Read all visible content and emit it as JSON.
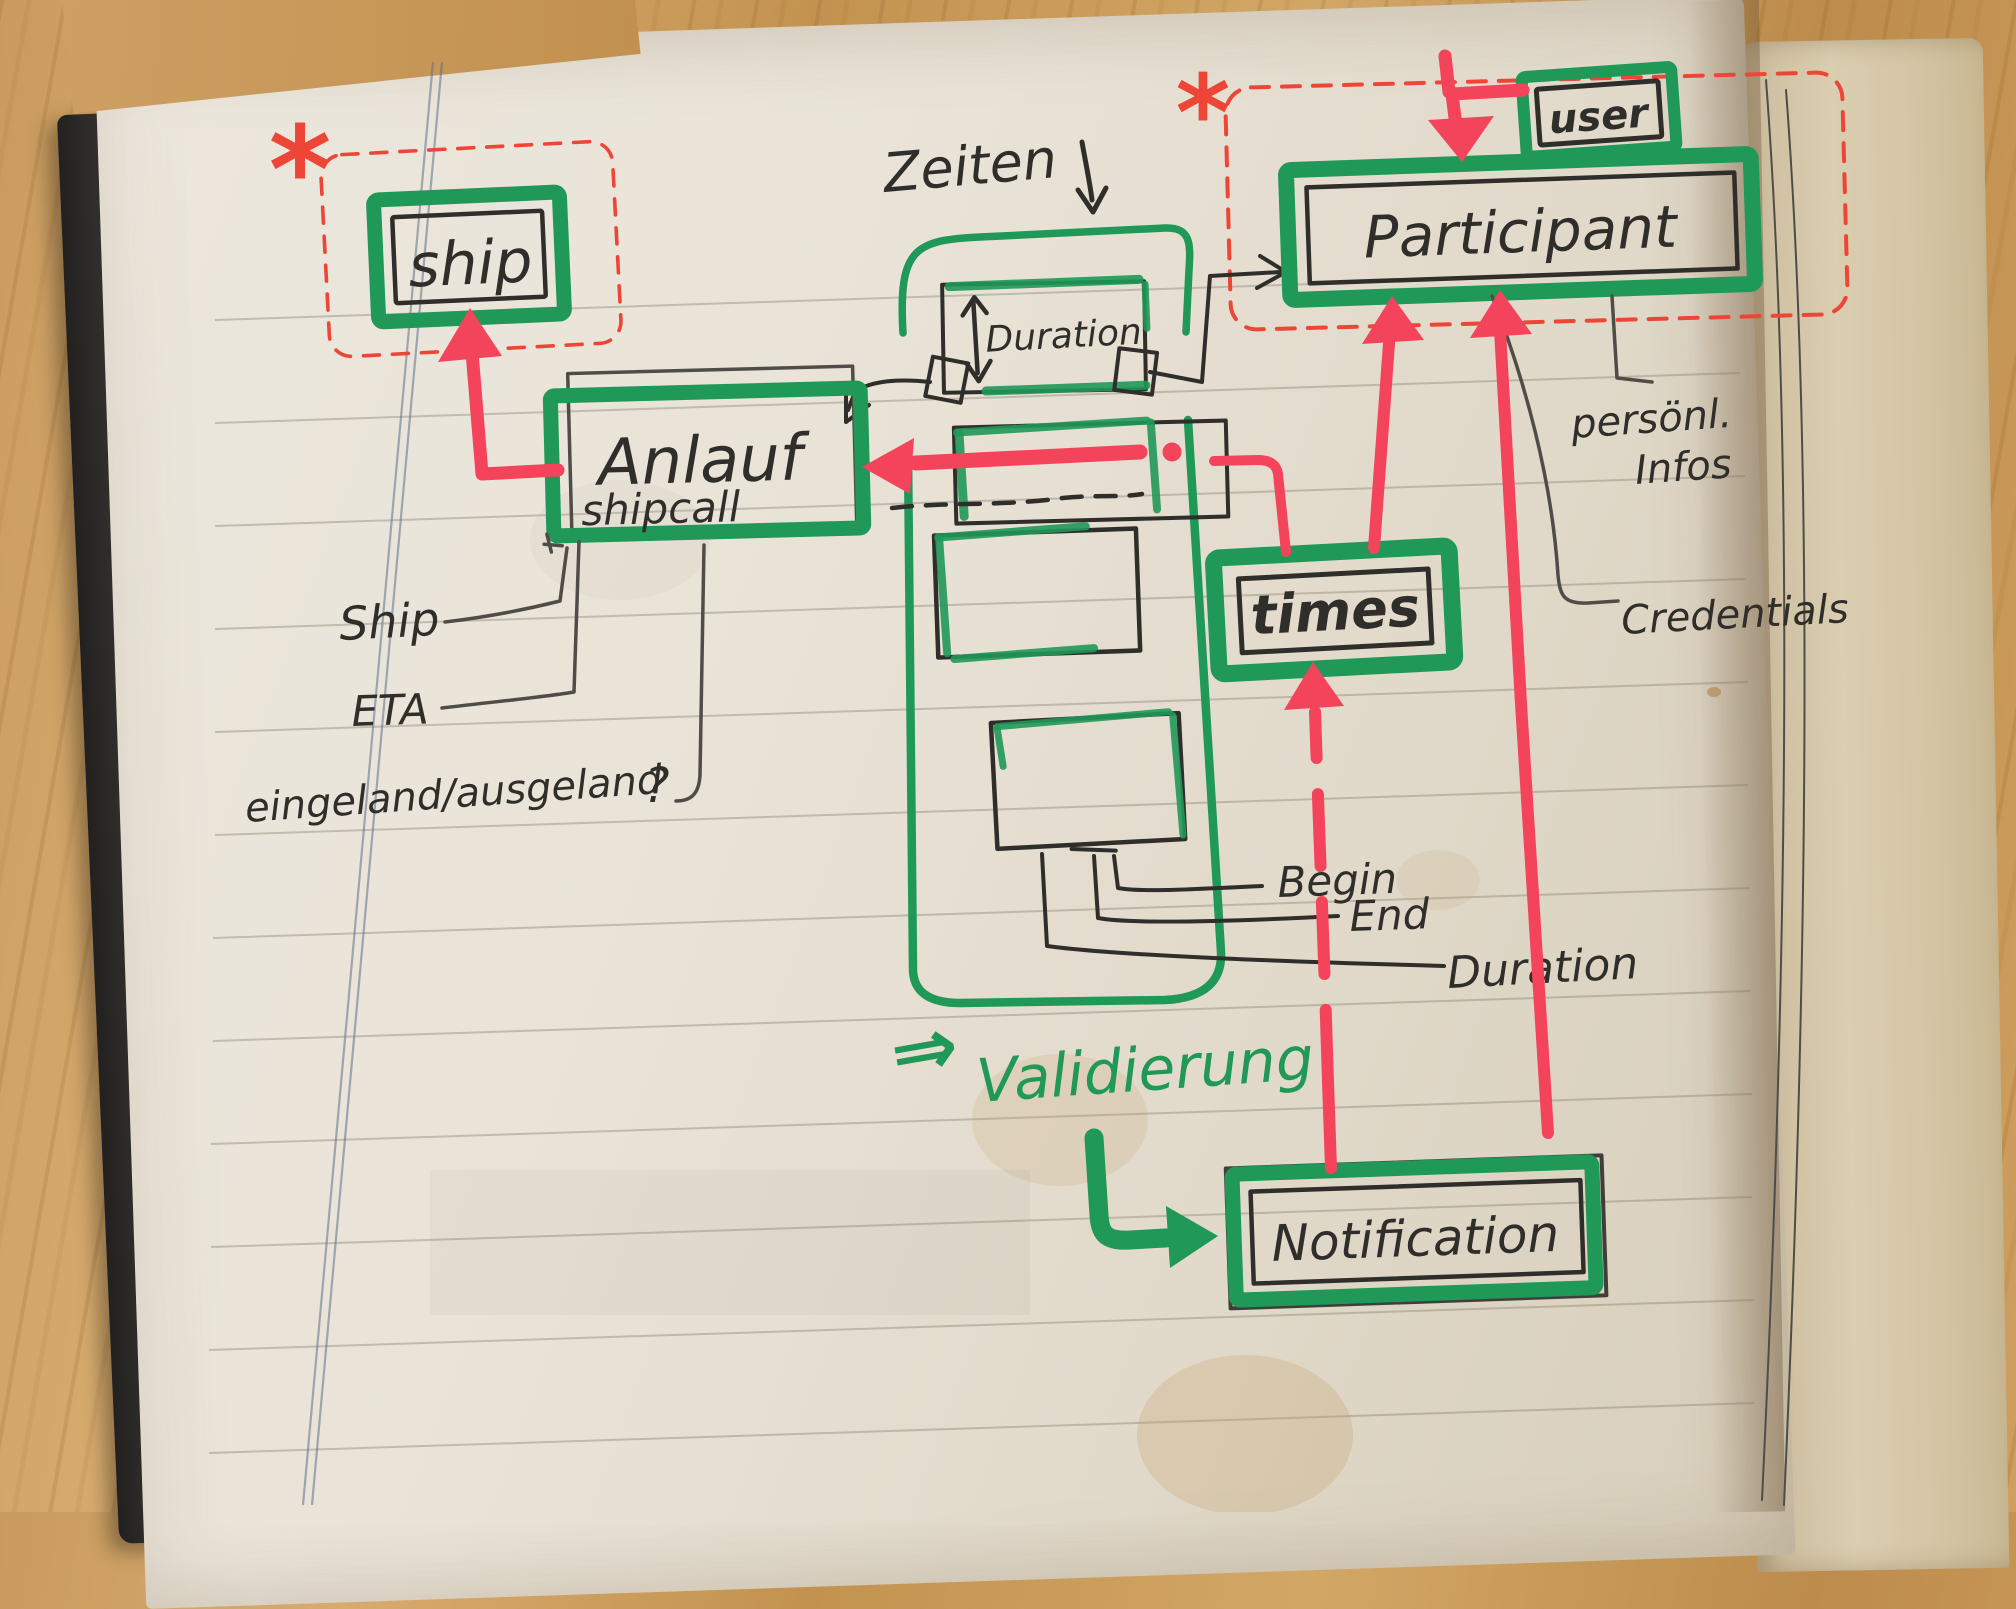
{
  "nodes": {
    "ship": {
      "label": "ship"
    },
    "anlauf": {
      "label": "Anlauf",
      "sublabel": "shipcall"
    },
    "duration": {
      "label": "Duration"
    },
    "participant": {
      "label": "Participant"
    },
    "user": {
      "label": "user"
    },
    "times": {
      "label": "times"
    },
    "notification": {
      "label": "Notification"
    }
  },
  "annotations": {
    "zeiten": "Zeiten",
    "validierung": "Validierung",
    "validierung_arrow": "⇒",
    "asterisk_left": "*",
    "asterisk_right": "*"
  },
  "attributes": {
    "ship": "Ship",
    "eta": "ETA",
    "eingeland": "eingeland/ausgeland",
    "question_mark": "?",
    "begin": "Begin",
    "end": "End",
    "duration": "Duration",
    "persoenl_line1": "persönl.",
    "persoenl_line2": "Infos",
    "credentials": "Credentials"
  },
  "colors": {
    "marker_green": "#1f9858",
    "marker_red": "#f4445c",
    "pen_red": "#ee4636",
    "ink": "#2f2e2b",
    "paper": "#e9e3d7",
    "wood": "#c99b5e"
  }
}
